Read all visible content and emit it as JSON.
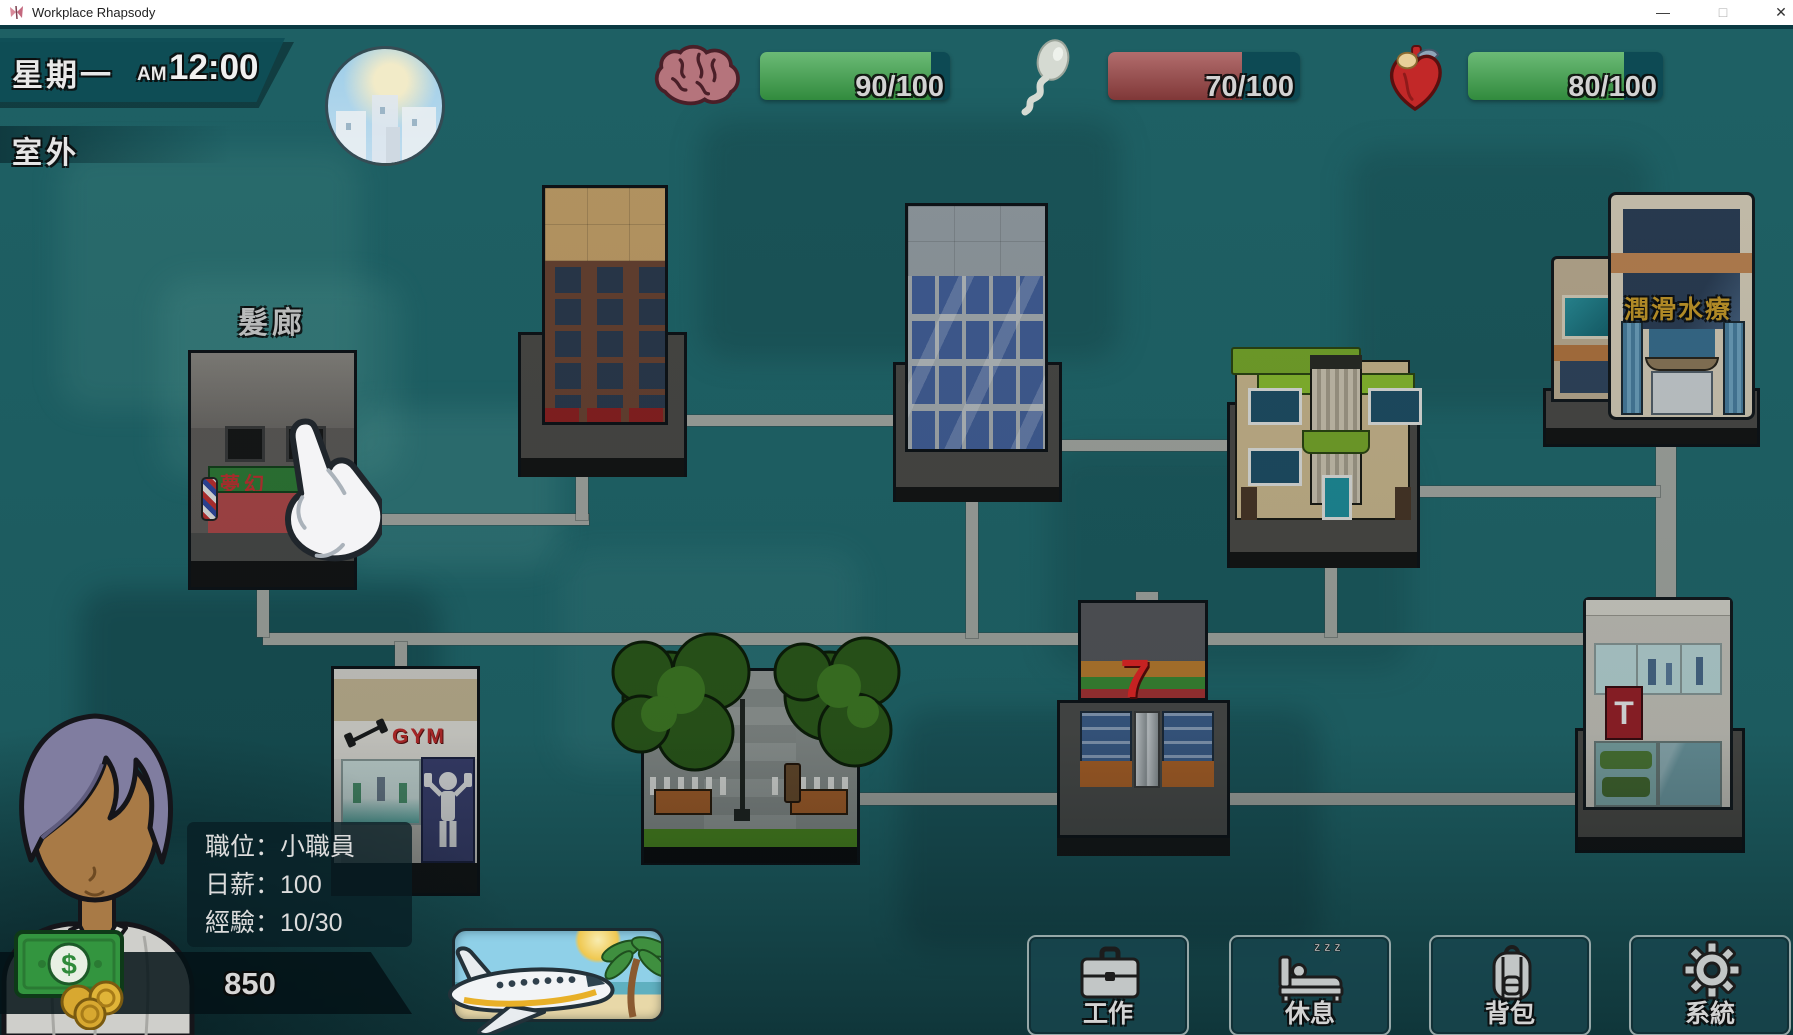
{
  "window": {
    "title": "Workplace Rhapsody",
    "minimize": "—",
    "maximize": "□",
    "close": "✕"
  },
  "hud": {
    "day": "星期一",
    "meridiem": "AM",
    "time": "12:00",
    "location": "室外",
    "stats": [
      {
        "id": "intellect",
        "icon": "brain-icon",
        "value": 90,
        "max": 100,
        "label": "90/100",
        "percent": 90,
        "fill_color": "#3aa348"
      },
      {
        "id": "energy",
        "icon": "sperm-icon",
        "value": 70,
        "max": 100,
        "label": "70/100",
        "percent": 70,
        "fill_color": "#9c4444"
      },
      {
        "id": "health",
        "icon": "heart-icon",
        "value": 80,
        "max": 100,
        "label": "80/100",
        "percent": 80,
        "fill_color": "#3aa348"
      }
    ]
  },
  "player": {
    "rows": [
      {
        "label": "職位：",
        "value": "小職員"
      },
      {
        "label": "日薪：",
        "value": "100"
      },
      {
        "label": "經驗：",
        "value": "10/30"
      }
    ],
    "money": "850",
    "money_symbol": "$"
  },
  "map": {
    "salon": {
      "label": "髮廊",
      "sign": "夢幻"
    },
    "spa": {
      "label": "潤滑水療"
    },
    "gym": {
      "sign": "GYM"
    },
    "seven": {
      "sign": "7"
    },
    "tstore": {
      "sign": "T"
    }
  },
  "actions": [
    {
      "id": "work",
      "label": "工作"
    },
    {
      "id": "rest",
      "label": "休息",
      "zzz": "z z z"
    },
    {
      "id": "backpack",
      "label": "背包"
    },
    {
      "id": "system",
      "label": "系統"
    }
  ],
  "colors": {
    "bar_green": "#3aa348",
    "bar_red": "#9c4444",
    "bar_track": "#0d4a54",
    "hud_banner": "#11525a",
    "road": "#a7aaa4",
    "gold_sign": "#c89a28"
  }
}
